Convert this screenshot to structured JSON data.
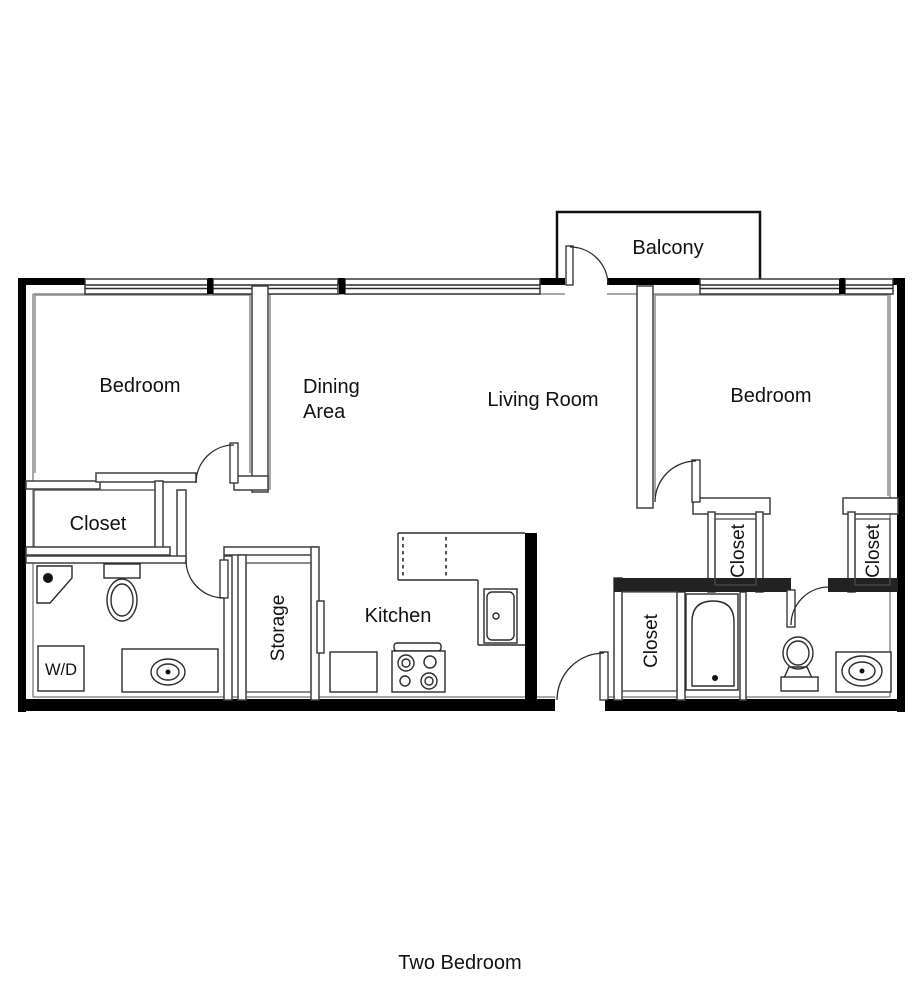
{
  "title": "Two Bedroom",
  "labels": {
    "balcony": "Balcony",
    "bedroom_left": "Bedroom",
    "bedroom_right": "Bedroom",
    "dining_line1": "Dining",
    "dining_line2": "Area",
    "living_room": "Living Room",
    "closet_left": "Closet",
    "closet_entry": "Closet",
    "closet_bedroom_a": "Closet",
    "closet_bedroom_b": "Closet",
    "storage": "Storage",
    "kitchen": "Kitchen",
    "washer_dryer": "W/D"
  },
  "colors": {
    "background": "#ffffff",
    "outer_wall": "#000000",
    "interior_wall": "#3f3f3f",
    "inner_face": "#8c8c8c",
    "text": "#111111"
  }
}
